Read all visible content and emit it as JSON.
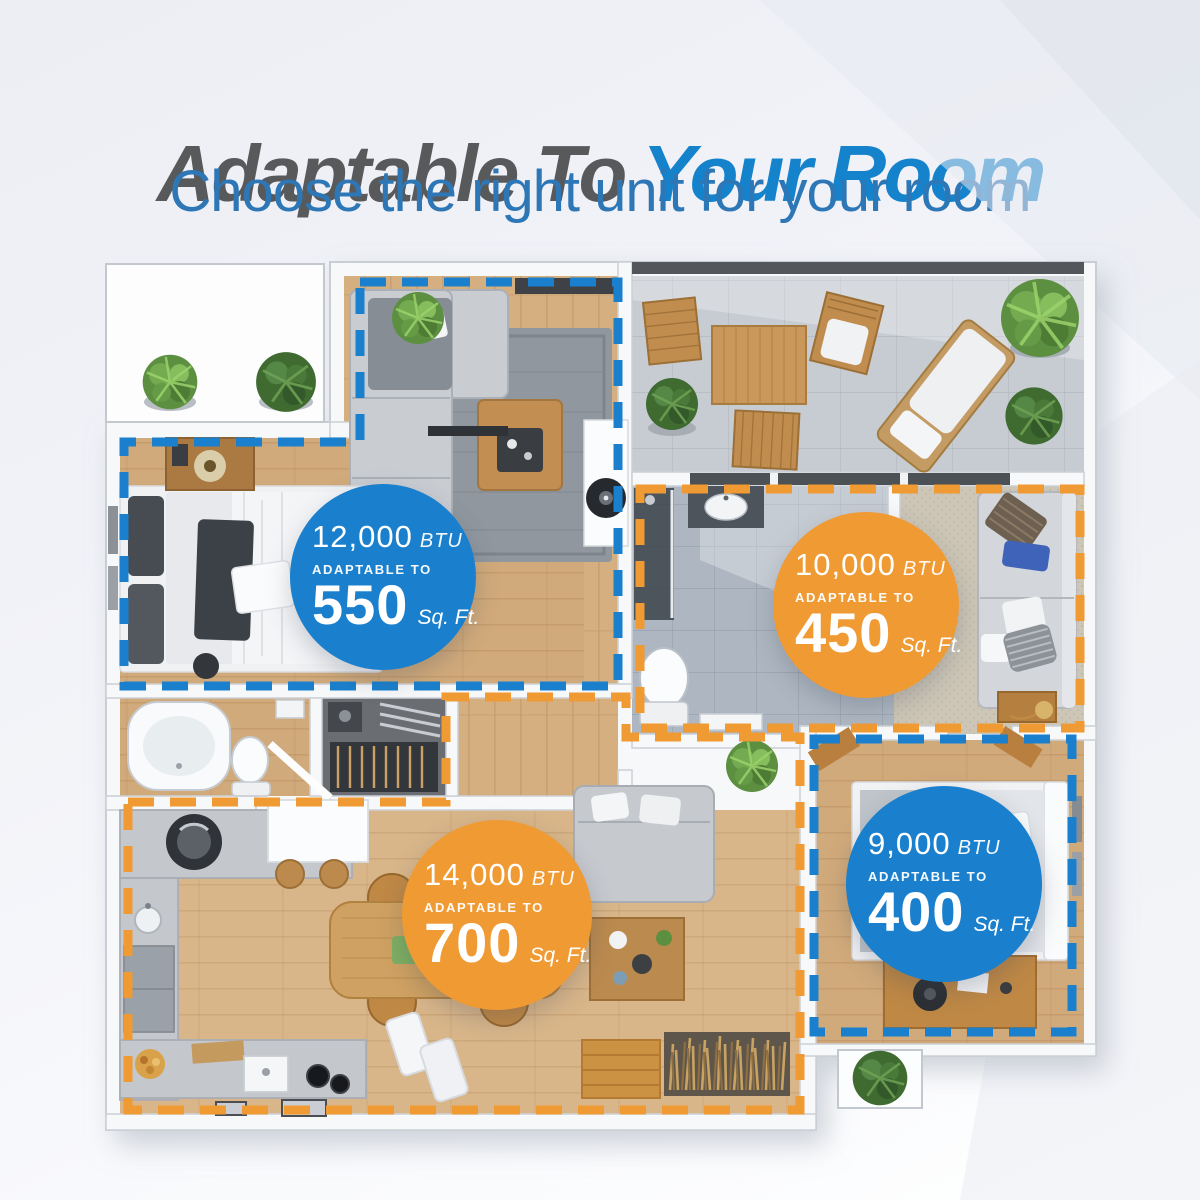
{
  "header": {
    "title_gray": "Adaptable To",
    "title_blue": "Your Room",
    "subtitle": "Choose the right unit for your room"
  },
  "colors": {
    "zone_blue": "#1a80cd",
    "zone_orange": "#f09a33",
    "title_gray": "#58595b",
    "title_blue": "#1583cc",
    "subtitle_blue": "#2e77b6"
  },
  "badges": [
    {
      "id": "living-bedroom",
      "color": "blue",
      "btu": "12,000",
      "btu_unit": "BTU",
      "adaptable_label": "ADAPTABLE TO",
      "sqft": "550",
      "sqft_unit": "Sq. Ft."
    },
    {
      "id": "bath-bedroom",
      "color": "orange",
      "btu": "10,000",
      "btu_unit": "BTU",
      "adaptable_label": "ADAPTABLE TO",
      "sqft": "450",
      "sqft_unit": "Sq. Ft."
    },
    {
      "id": "kitchen-dining",
      "color": "orange",
      "btu": "14,000",
      "btu_unit": "BTU",
      "adaptable_label": "ADAPTABLE TO",
      "sqft": "700",
      "sqft_unit": "Sq. Ft."
    },
    {
      "id": "office-bedroom",
      "color": "blue",
      "btu": "9,000",
      "btu_unit": "BTU",
      "adaptable_label": "ADAPTABLE TO",
      "sqft": "400",
      "sqft_unit": "Sq. Ft."
    }
  ]
}
